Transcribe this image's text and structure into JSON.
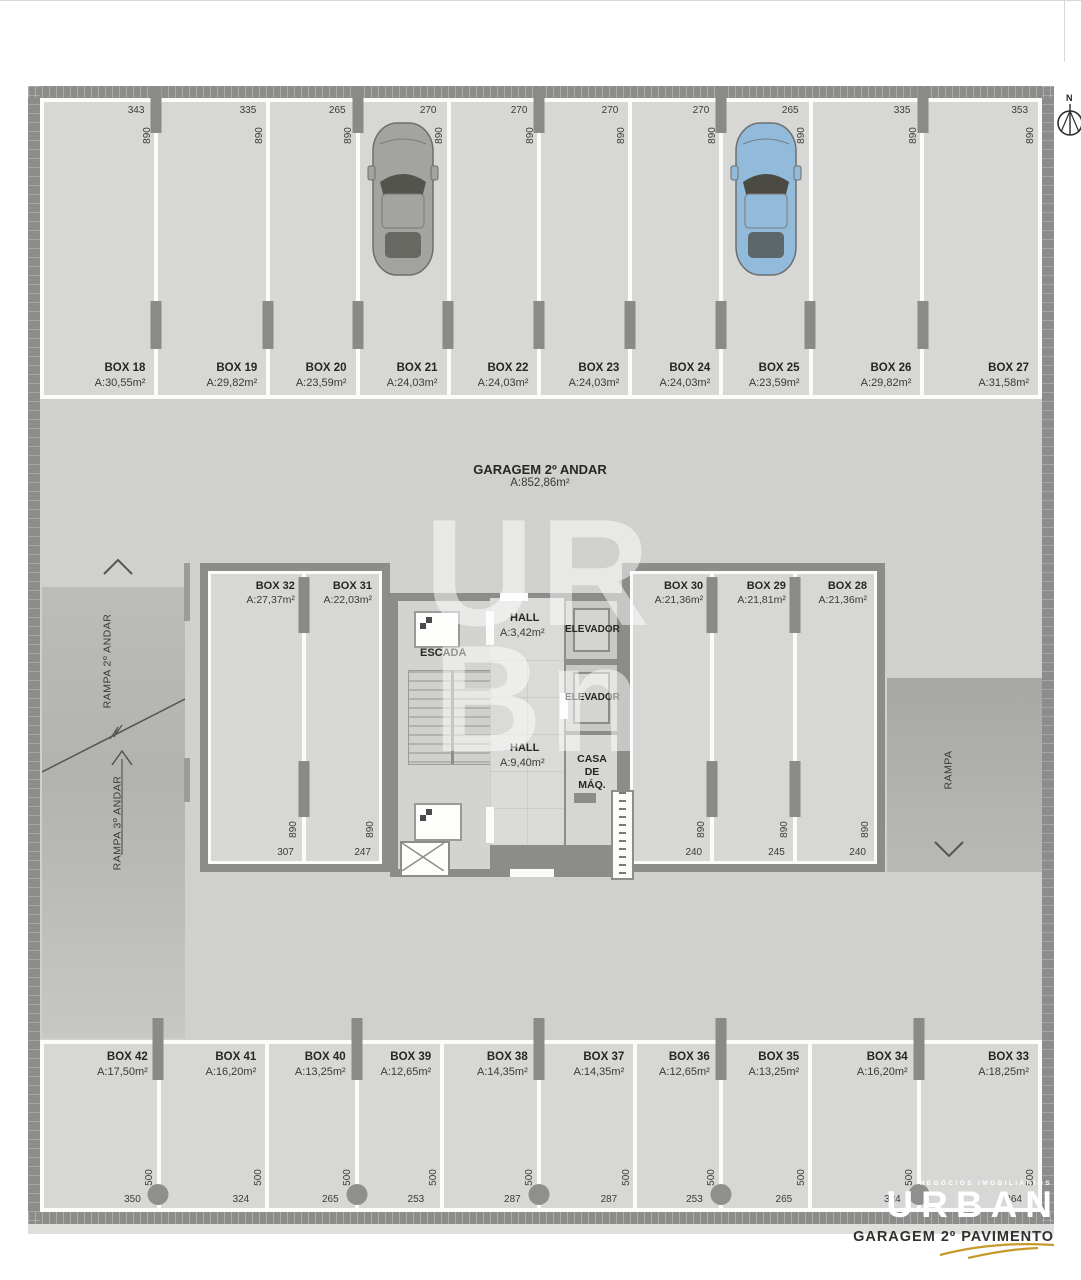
{
  "title": {
    "floor_label": "GARAGEM 2º ANDAR",
    "floor_area": "A:852,86m²"
  },
  "compass": {
    "label": "N"
  },
  "watermark": {
    "line1": "UR",
    "line2": "Bn"
  },
  "colors": {
    "wall": "#8c8c8a",
    "floor": "#d0d0ce",
    "stall_floor": "#d7d7d5",
    "white_line": "#fbfbfa",
    "logo_accent": "#c49a2c",
    "car_gray_body": "#a3a3a1",
    "car_gray_glass": "#54544e",
    "car_blue_body": "#92bbdb",
    "car_blue_glass": "#4b4b43"
  },
  "top_row": {
    "stalls": [
      {
        "name": "BOX 18",
        "area": "A:30,55m²",
        "width": 343,
        "width_label": "343",
        "depth_label": "890"
      },
      {
        "name": "BOX 19",
        "area": "A:29,82m²",
        "width": 335,
        "width_label": "335",
        "depth_label": "890"
      },
      {
        "name": "BOX 20",
        "area": "A:23,59m²",
        "width": 265,
        "width_label": "265",
        "depth_label": "890"
      },
      {
        "name": "BOX 21",
        "area": "A:24,03m²",
        "width": 270,
        "width_label": "270",
        "depth_label": "890",
        "car": {
          "body": "#a3a3a1",
          "glass": "#54544e"
        }
      },
      {
        "name": "BOX 22",
        "area": "A:24,03m²",
        "width": 270,
        "width_label": "270",
        "depth_label": "890"
      },
      {
        "name": "BOX 23",
        "area": "A:24,03m²",
        "width": 270,
        "width_label": "270",
        "depth_label": "890"
      },
      {
        "name": "BOX 24",
        "area": "A:24,03m²",
        "width": 270,
        "width_label": "270",
        "depth_label": "890"
      },
      {
        "name": "BOX 25",
        "area": "A:23,59m²",
        "width": 265,
        "width_label": "265",
        "depth_label": "890",
        "car": {
          "body": "#92bbdb",
          "glass": "#4b4b43"
        }
      },
      {
        "name": "BOX 26",
        "area": "A:29,82m²",
        "width": 335,
        "width_label": "335",
        "depth_label": "890"
      },
      {
        "name": "BOX 27",
        "area": "A:31,58m²",
        "width": 353,
        "width_label": "353",
        "depth_label": "890"
      }
    ]
  },
  "bottom_row": {
    "stalls": [
      {
        "name": "BOX 42",
        "area": "A:17,50m²",
        "width": 350,
        "width_label": "350",
        "depth_label": "500"
      },
      {
        "name": "BOX 41",
        "area": "A:16,20m²",
        "width": 324,
        "width_label": "324",
        "depth_label": "500"
      },
      {
        "name": "BOX 40",
        "area": "A:13,25m²",
        "width": 265,
        "width_label": "265",
        "depth_label": "500"
      },
      {
        "name": "BOX 39",
        "area": "A:12,65m²",
        "width": 253,
        "width_label": "253",
        "depth_label": "500"
      },
      {
        "name": "BOX 38",
        "area": "A:14,35m²",
        "width": 287,
        "width_label": "287",
        "depth_label": "500"
      },
      {
        "name": "BOX 37",
        "area": "A:14,35m²",
        "width": 287,
        "width_label": "287",
        "depth_label": "500"
      },
      {
        "name": "BOX 36",
        "area": "A:12,65m²",
        "width": 253,
        "width_label": "253",
        "depth_label": "500"
      },
      {
        "name": "BOX 35",
        "area": "A:13,25m²",
        "width": 265,
        "width_label": "265",
        "depth_label": "500"
      },
      {
        "name": "BOX 34",
        "area": "A:16,20m²",
        "width": 324,
        "width_label": "324",
        "depth_label": "500"
      },
      {
        "name": "BOX 33",
        "area": "A:18,25m²",
        "width": 364,
        "width_label": "364",
        "depth_label": "500"
      }
    ]
  },
  "left_block": {
    "stalls": [
      {
        "name": "BOX 32",
        "area": "A:27,37m²",
        "width": 307,
        "width_label": "307",
        "depth_label": "890"
      },
      {
        "name": "BOX 31",
        "area": "A:22,03m²",
        "width": 247,
        "width_label": "247",
        "depth_label": "890"
      }
    ]
  },
  "right_block": {
    "stalls": [
      {
        "name": "BOX 30",
        "area": "A:21,36m²",
        "width": 240,
        "width_label": "240",
        "depth_label": "890"
      },
      {
        "name": "BOX 29",
        "area": "A:21,81m²",
        "width": 245,
        "width_label": "245",
        "depth_label": "890"
      },
      {
        "name": "BOX 28",
        "area": "A:21,36m²",
        "width": 240,
        "width_label": "240",
        "depth_label": "890"
      }
    ]
  },
  "core": {
    "escada_label": "ESCADA",
    "hall_upper": {
      "name": "HALL",
      "area": "A:3,42m²"
    },
    "elevator1_label": "ELEVADOR",
    "elevator2_label": "ELEVADOR",
    "hall_lower": {
      "name": "HALL",
      "area": "A:9,40m²"
    },
    "casa_maq_label": "CASA DE MÁQ."
  },
  "ramps": {
    "left_upper_label": "RAMPA 2º ANDAR",
    "left_lower_label": "RAMPA 3º ANDAR",
    "right_label": "RAMPA"
  },
  "logo": {
    "tagline": "NEGÓCIOS IMOBILIÁRIOS",
    "brand": "URBAN",
    "caption": "GARAGEM 2º PAVIMENTO"
  }
}
